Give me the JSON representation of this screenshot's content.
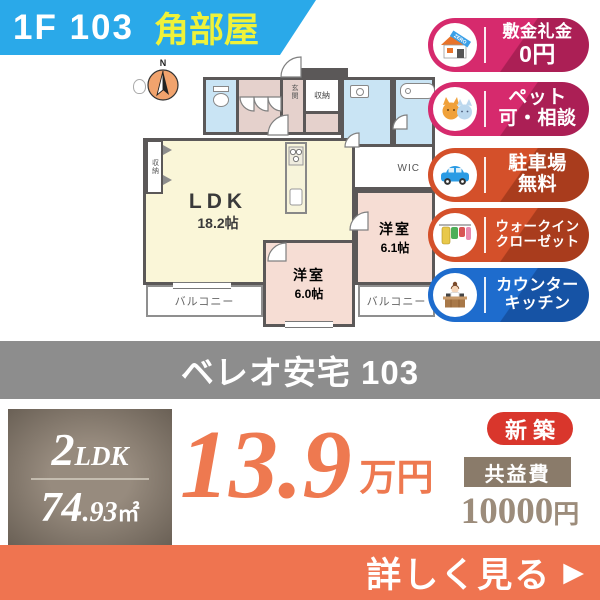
{
  "header": {
    "unit": "1F 103",
    "corner_label": "角部屋"
  },
  "floorplan": {
    "compass_label": "N",
    "rooms": {
      "ldk": {
        "name": "LDK",
        "size": "18.2帖"
      },
      "bedroom1": {
        "name": "洋室",
        "size": "6.1帖"
      },
      "bedroom2": {
        "name": "洋室",
        "size": "6.0帖"
      },
      "wic": "WIC",
      "closet_top": "収納",
      "closet_left": "収納",
      "entrance": "玄関",
      "balcony_left": "バルコニー",
      "balcony_right": "バルコニー"
    }
  },
  "badges": [
    {
      "id": "no-deposit",
      "icon": "house-zero-icon",
      "icon_text": "ZERO",
      "lines": [
        "敷金礼金",
        "0円"
      ],
      "color": "#d62a6d"
    },
    {
      "id": "pets-ok",
      "icon": "cats-icon",
      "lines": [
        "ペット",
        "可・相談"
      ],
      "color": "#d62a6d"
    },
    {
      "id": "free-parking",
      "icon": "car-icon",
      "lines": [
        "駐車場",
        "無料"
      ],
      "color": "#d4502a"
    },
    {
      "id": "walk-in-closet",
      "icon": "clothes-icon",
      "lines": [
        "ウォークイン",
        "クローゼット"
      ],
      "color": "#d4502a"
    },
    {
      "id": "counter-kitchen",
      "icon": "kitchen-icon",
      "lines": [
        "カウンター",
        "キッチン"
      ],
      "color": "#1e6ccd"
    }
  ],
  "title_bar": {
    "name": "ベレオ安宅 103"
  },
  "summary": {
    "layout_num": "2",
    "layout_rooms": "LDK",
    "area_main": "74",
    "area_dec": ".93",
    "area_unit": "㎡",
    "rent_value": "13.9",
    "rent_unit": "万円",
    "new_label": "新築",
    "fee_label": "共益費",
    "fee_value": "10000",
    "fee_unit": "円"
  },
  "cta": {
    "label": "詳しく見る",
    "arrow": "▶"
  },
  "colors": {
    "header_blue": "#2aa9e9",
    "corner_yellow": "#eef23a",
    "badge_pink": "#d62a6d",
    "badge_orange": "#d4502a",
    "badge_blue": "#1e6ccd",
    "title_gray": "#8d8d8d",
    "spec_brown": "#8a7e72",
    "price_orange": "#ee7950",
    "new_red": "#d9362c",
    "fee_brown": "#9c8c7b",
    "cta_orange": "#ef7450",
    "wall_gray": "#5b5858"
  }
}
